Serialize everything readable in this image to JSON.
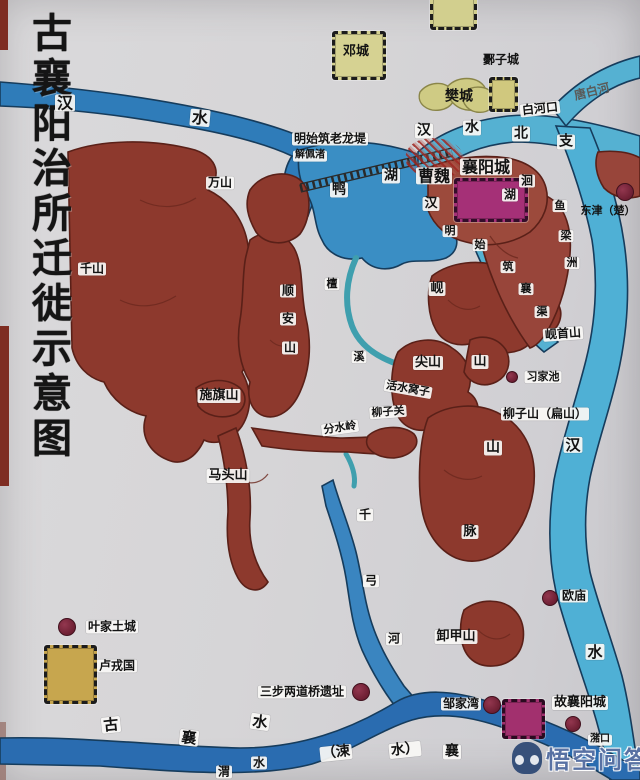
{
  "map": {
    "title": "古襄阳治所迁徙示意图",
    "watermark": {
      "text": "悟空问答"
    },
    "colors": {
      "paper": "#d6d5d7",
      "river_deep": "#2f7cb9",
      "river_light": "#55b1d2",
      "stream_teal": "#3f9fae",
      "mountain": "#8d392d",
      "island": "#98453a",
      "city_magenta": "#a53077",
      "castle_yellow": "#c7a64e",
      "marker": "#7c2740"
    },
    "labels": [
      {
        "t": "汉",
        "x": 65,
        "y": 103,
        "s": 16,
        "n": "hanshui-label-west"
      },
      {
        "t": "水",
        "x": 200,
        "y": 118,
        "s": 16,
        "r": 5,
        "n": "hanshui-label-west-2"
      },
      {
        "t": "邓城",
        "x": 356,
        "y": 52,
        "s": 13,
        "b": 0,
        "n": "dengcheng-label"
      },
      {
        "t": "鄾子城",
        "x": 501,
        "y": 60,
        "s": 12,
        "b": 0,
        "n": "youzicheng-label"
      },
      {
        "t": "樊城",
        "x": 459,
        "y": 97,
        "s": 14,
        "b": 0,
        "n": "fancheng-label"
      },
      {
        "t": "白河口",
        "x": 540,
        "y": 109,
        "s": 12,
        "r": -6,
        "n": "baihekou-label"
      },
      {
        "t": "唐白河",
        "x": 592,
        "y": 92,
        "s": 12,
        "r": -14,
        "b": 0,
        "c": "#5a5a58",
        "n": "tangbaihe-label"
      },
      {
        "t": "汉",
        "x": 424,
        "y": 131,
        "s": 14,
        "n": "hanshui-north-1"
      },
      {
        "t": "水",
        "x": 472,
        "y": 128,
        "s": 14,
        "n": "hanshui-north-2"
      },
      {
        "t": "北",
        "x": 521,
        "y": 134,
        "s": 14,
        "n": "hanshui-north-3"
      },
      {
        "t": "支",
        "x": 566,
        "y": 142,
        "s": 14,
        "n": "hanshui-north-4"
      },
      {
        "t": "明始筑老龙堤",
        "x": 330,
        "y": 139,
        "s": 12,
        "n": "laolongdi-label"
      },
      {
        "t": "解佩渚",
        "x": 310,
        "y": 156,
        "s": 10,
        "n": "jiepeizhu-label"
      },
      {
        "t": "万山",
        "x": 220,
        "y": 183,
        "s": 12,
        "n": "wanshan-label"
      },
      {
        "t": "鸭",
        "x": 339,
        "y": 190,
        "s": 14,
        "n": "yahu-label-1"
      },
      {
        "t": "湖",
        "x": 391,
        "y": 176,
        "s": 14,
        "n": "yahu-label-2"
      },
      {
        "t": "曹魏",
        "x": 434,
        "y": 176,
        "s": 16,
        "n": "caowei-label"
      },
      {
        "t": "襄阳城",
        "x": 486,
        "y": 167,
        "s": 16,
        "n": "xiangyangcheng-label"
      },
      {
        "t": "汉",
        "x": 431,
        "y": 204,
        "s": 13,
        "n": "han-channel-label"
      },
      {
        "t": "洄",
        "x": 527,
        "y": 181,
        "s": 12,
        "n": "huihu-label-1"
      },
      {
        "t": "湖",
        "x": 510,
        "y": 195,
        "s": 12,
        "n": "huihu-label-2"
      },
      {
        "t": "鱼",
        "x": 560,
        "y": 206,
        "s": 11,
        "n": "yuliangzhou-label-1"
      },
      {
        "t": "梁",
        "x": 566,
        "y": 236,
        "s": 11,
        "n": "yuliangzhou-label-2"
      },
      {
        "t": "洲",
        "x": 572,
        "y": 263,
        "s": 11,
        "n": "yuliangzhou-label-3"
      },
      {
        "t": "东津（楚）",
        "x": 608,
        "y": 211,
        "s": 11,
        "b": 0,
        "n": "dongjin-label"
      },
      {
        "t": "明",
        "x": 450,
        "y": 231,
        "s": 11,
        "n": "xiangqu-text-1"
      },
      {
        "t": "始",
        "x": 480,
        "y": 245,
        "s": 11,
        "n": "xiangqu-text-2"
      },
      {
        "t": "筑",
        "x": 508,
        "y": 267,
        "s": 11,
        "n": "xiangqu-text-3"
      },
      {
        "t": "襄",
        "x": 526,
        "y": 289,
        "s": 11,
        "n": "xiangqu-text-4"
      },
      {
        "t": "渠",
        "x": 542,
        "y": 312,
        "s": 11,
        "n": "xiangqu-text-5"
      },
      {
        "t": "千山",
        "x": 92,
        "y": 269,
        "s": 12,
        "n": "qianshan-label"
      },
      {
        "t": "顺",
        "x": 288,
        "y": 291,
        "s": 12,
        "n": "shunanshan-label-1"
      },
      {
        "t": "安",
        "x": 288,
        "y": 319,
        "s": 12,
        "n": "shunanshan-label-2"
      },
      {
        "t": "山",
        "x": 290,
        "y": 348,
        "s": 12,
        "n": "shunanshan-label-3"
      },
      {
        "t": "檀",
        "x": 332,
        "y": 284,
        "s": 11,
        "n": "tanxi-label-1"
      },
      {
        "t": "溪",
        "x": 359,
        "y": 357,
        "s": 11,
        "n": "tanxi-label-2"
      },
      {
        "t": "岘",
        "x": 437,
        "y": 289,
        "s": 13,
        "n": "xianshan-label-1"
      },
      {
        "t": "山",
        "x": 480,
        "y": 362,
        "s": 13,
        "n": "xianshan-label-2"
      },
      {
        "t": "尖山",
        "x": 428,
        "y": 363,
        "s": 13,
        "n": "jianshan-label"
      },
      {
        "t": "岘首山",
        "x": 563,
        "y": 334,
        "s": 12,
        "r": -4,
        "n": "xianshoushan-label"
      },
      {
        "t": "习家池",
        "x": 543,
        "y": 377,
        "s": 11,
        "n": "xijiachi-label"
      },
      {
        "t": "活水窝子",
        "x": 408,
        "y": 389,
        "s": 11,
        "r": 10,
        "n": "huoshuiwozi-label"
      },
      {
        "t": "柳子关",
        "x": 388,
        "y": 412,
        "s": 11,
        "r": -4,
        "n": "liuziguan-label"
      },
      {
        "t": "分水岭",
        "x": 340,
        "y": 428,
        "s": 11,
        "r": -8,
        "n": "fenshuiling-label"
      },
      {
        "t": "柳子山（扁山）",
        "x": 545,
        "y": 414,
        "s": 12,
        "n": "liuzishan-label"
      },
      {
        "t": "施旗山",
        "x": 219,
        "y": 396,
        "s": 13,
        "n": "shiqishan-label"
      },
      {
        "t": "马头山",
        "x": 228,
        "y": 476,
        "s": 13,
        "n": "matoushan-label"
      },
      {
        "t": "汉",
        "x": 573,
        "y": 445,
        "s": 15,
        "n": "hanshui-east-1"
      },
      {
        "t": "山",
        "x": 493,
        "y": 448,
        "s": 14,
        "n": "shanmai-label-1"
      },
      {
        "t": "脉",
        "x": 470,
        "y": 532,
        "s": 13,
        "n": "shanmai-label-2"
      },
      {
        "t": "千",
        "x": 365,
        "y": 515,
        "s": 12,
        "n": "qiangonghe-label-1"
      },
      {
        "t": "弓",
        "x": 371,
        "y": 581,
        "s": 12,
        "n": "qiangonghe-label-2"
      },
      {
        "t": "河",
        "x": 394,
        "y": 639,
        "s": 12,
        "n": "qiangonghe-label-3"
      },
      {
        "t": "叶家土城",
        "x": 112,
        "y": 627,
        "s": 12,
        "n": "yejiatucheng-label"
      },
      {
        "t": "卢戎国",
        "x": 117,
        "y": 666,
        "s": 12,
        "n": "lurongguo-label"
      },
      {
        "t": "欧庙",
        "x": 574,
        "y": 596,
        "s": 12,
        "n": "oumiao-label"
      },
      {
        "t": "卸甲山",
        "x": 456,
        "y": 637,
        "s": 13,
        "n": "xiejiashan-label"
      },
      {
        "t": "水",
        "x": 595,
        "y": 652,
        "s": 15,
        "n": "hanshui-east-2"
      },
      {
        "t": "三步两道桥遗址",
        "x": 302,
        "y": 692,
        "s": 12,
        "n": "sanbu-bridge-label"
      },
      {
        "t": "邹家湾",
        "x": 461,
        "y": 704,
        "s": 12,
        "n": "zoujiawan-label"
      },
      {
        "t": "故襄阳城",
        "x": 580,
        "y": 703,
        "s": 13,
        "n": "guxiangyangcheng-label"
      },
      {
        "t": "潴口",
        "x": 600,
        "y": 740,
        "s": 10,
        "n": "zhukou-label"
      },
      {
        "t": "古",
        "x": 111,
        "y": 725,
        "s": 15,
        "r": -6,
        "n": "guxiangshui-label-1"
      },
      {
        "t": "襄",
        "x": 189,
        "y": 738,
        "s": 15,
        "r": 6,
        "n": "guxiangshui-label-2"
      },
      {
        "t": "水",
        "x": 260,
        "y": 722,
        "s": 15,
        "r": 8,
        "n": "guxiangshui-label-3"
      },
      {
        "t": "（涑",
        "x": 336,
        "y": 753,
        "s": 14,
        "r": -6,
        "n": "sushui-label-1"
      },
      {
        "t": "水）",
        "x": 405,
        "y": 750,
        "s": 14,
        "r": -6,
        "n": "sushui-label-2"
      },
      {
        "t": "襄",
        "x": 452,
        "y": 752,
        "s": 14,
        "n": "xiangshui-mouth-label"
      },
      {
        "t": "渭",
        "x": 224,
        "y": 772,
        "s": 12,
        "n": "partial-label-1"
      },
      {
        "t": "水",
        "x": 259,
        "y": 763,
        "s": 12,
        "n": "partial-label-2"
      }
    ],
    "sites": [
      {
        "x": 67,
        "y": 627,
        "r": 8,
        "n": "yejiatucheng-marker"
      },
      {
        "x": 361,
        "y": 692,
        "r": 8,
        "n": "sanbu-bridge-marker"
      },
      {
        "x": 492,
        "y": 705,
        "r": 8,
        "n": "zoujiawan-marker"
      },
      {
        "x": 550,
        "y": 598,
        "r": 7,
        "n": "oumiao-marker"
      },
      {
        "x": 625,
        "y": 192,
        "r": 8,
        "n": "dongjin-marker"
      },
      {
        "x": 573,
        "y": 724,
        "r": 7,
        "n": "zhukou-marker"
      },
      {
        "x": 512,
        "y": 377,
        "r": 5,
        "n": "xijiachi-marker"
      }
    ],
    "castles": [
      {
        "x": 332,
        "y": 31,
        "w": 48,
        "h": 43,
        "f": "#d6d292",
        "bc": "#1c1c1c",
        "n": "dengcheng-castle-icon"
      },
      {
        "x": 489,
        "y": 77,
        "w": 23,
        "h": 29,
        "f": "#d0c87e",
        "bc": "#1c1c1c",
        "n": "youzicheng-castle-icon"
      },
      {
        "x": 430,
        "y": -6,
        "w": 41,
        "h": 30,
        "f": "#d2cf8e",
        "bc": "#1c1c1c",
        "n": "edge-castle-icon"
      },
      {
        "x": 44,
        "y": 645,
        "w": 47,
        "h": 53,
        "f": "#c7a64e",
        "bc": "#1c1c1c",
        "n": "lurongguo-castle-icon"
      },
      {
        "x": 502,
        "y": 699,
        "w": 37,
        "h": 34,
        "f": "#a2306e",
        "bc": "#2a0a20",
        "n": "guxiangyangcheng-castle-icon"
      },
      {
        "x": 454,
        "y": 178,
        "w": 68,
        "h": 38,
        "f": "#a53077",
        "bc": "#330d2a",
        "n": "xiangyangcheng-city-icon"
      }
    ]
  }
}
